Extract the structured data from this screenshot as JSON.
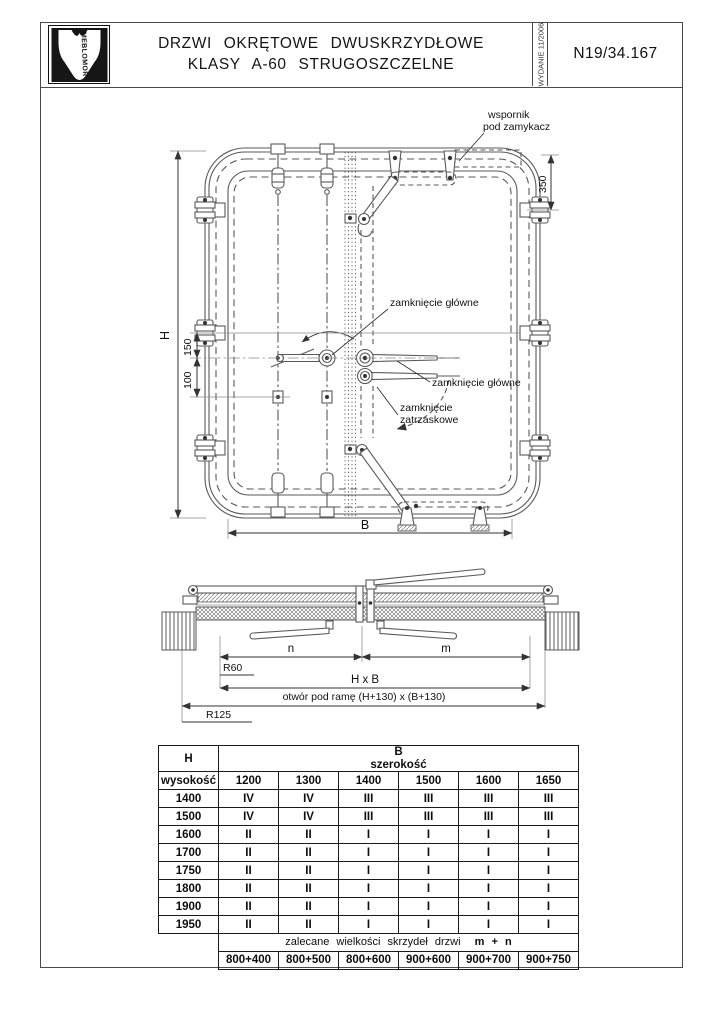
{
  "header": {
    "logo_text": "MEBLOMOR",
    "title_line1": "DRZWI  OKRĘTOWE  DWUSKRZYDŁOWE",
    "title_line2": "KLASY  A-60  STRUGOSZCZELNE",
    "edition": "WYDANIE 11/2006",
    "doc_number": "N19/34.167"
  },
  "front_view": {
    "bracket_label_line1": "wspornik",
    "bracket_label_line2": "pod  zamykacz",
    "dim_350": "350",
    "dim_H": "H",
    "dim_150": "150",
    "dim_100": "100",
    "dim_B": "B",
    "main_lock_label_top": "zamknięcie główne",
    "main_lock_label_right": "zamknięcie główne",
    "latch_label_line1": "zamknięcie",
    "latch_label_line2": "zatrzaskowe"
  },
  "section_view": {
    "dim_n": "n",
    "dim_m": "m",
    "radius_inner": "R60",
    "dim_hxb": "H x B",
    "opening_label": "otwór pod ramę (H+130) x (B+130)",
    "radius_outer": "R125"
  },
  "table": {
    "col_h_label": "H",
    "col_h_sub": "wysokość",
    "col_b_label": "B",
    "col_b_sub": "szerokość",
    "width_values": [
      "1200",
      "1300",
      "1400",
      "1500",
      "1600",
      "1650"
    ],
    "rows": [
      {
        "h": "1400",
        "values": [
          "IV",
          "IV",
          "III",
          "III",
          "III",
          "III"
        ]
      },
      {
        "h": "1500",
        "values": [
          "IV",
          "IV",
          "III",
          "III",
          "III",
          "III"
        ]
      },
      {
        "h": "1600",
        "values": [
          "II",
          "II",
          "I",
          "I",
          "I",
          "I"
        ]
      },
      {
        "h": "1700",
        "values": [
          "II",
          "II",
          "I",
          "I",
          "I",
          "I"
        ]
      },
      {
        "h": "1750",
        "values": [
          "II",
          "II",
          "I",
          "I",
          "I",
          "I"
        ]
      },
      {
        "h": "1800",
        "values": [
          "II",
          "II",
          "I",
          "I",
          "I",
          "I"
        ]
      },
      {
        "h": "1900",
        "values": [
          "II",
          "II",
          "I",
          "I",
          "I",
          "I"
        ]
      },
      {
        "h": "1950",
        "values": [
          "II",
          "II",
          "I",
          "I",
          "I",
          "I"
        ]
      }
    ],
    "footer_note": "zalecane  wielkości  skrzydeł  drzwi",
    "footer_note_bold": "m + n",
    "leaf_sizes": [
      "800+400",
      "800+500",
      "800+600",
      "900+600",
      "900+700",
      "900+750"
    ]
  },
  "colors": {
    "line": "#5a5a5a",
    "text": "#111111",
    "paper": "#ffffff"
  }
}
